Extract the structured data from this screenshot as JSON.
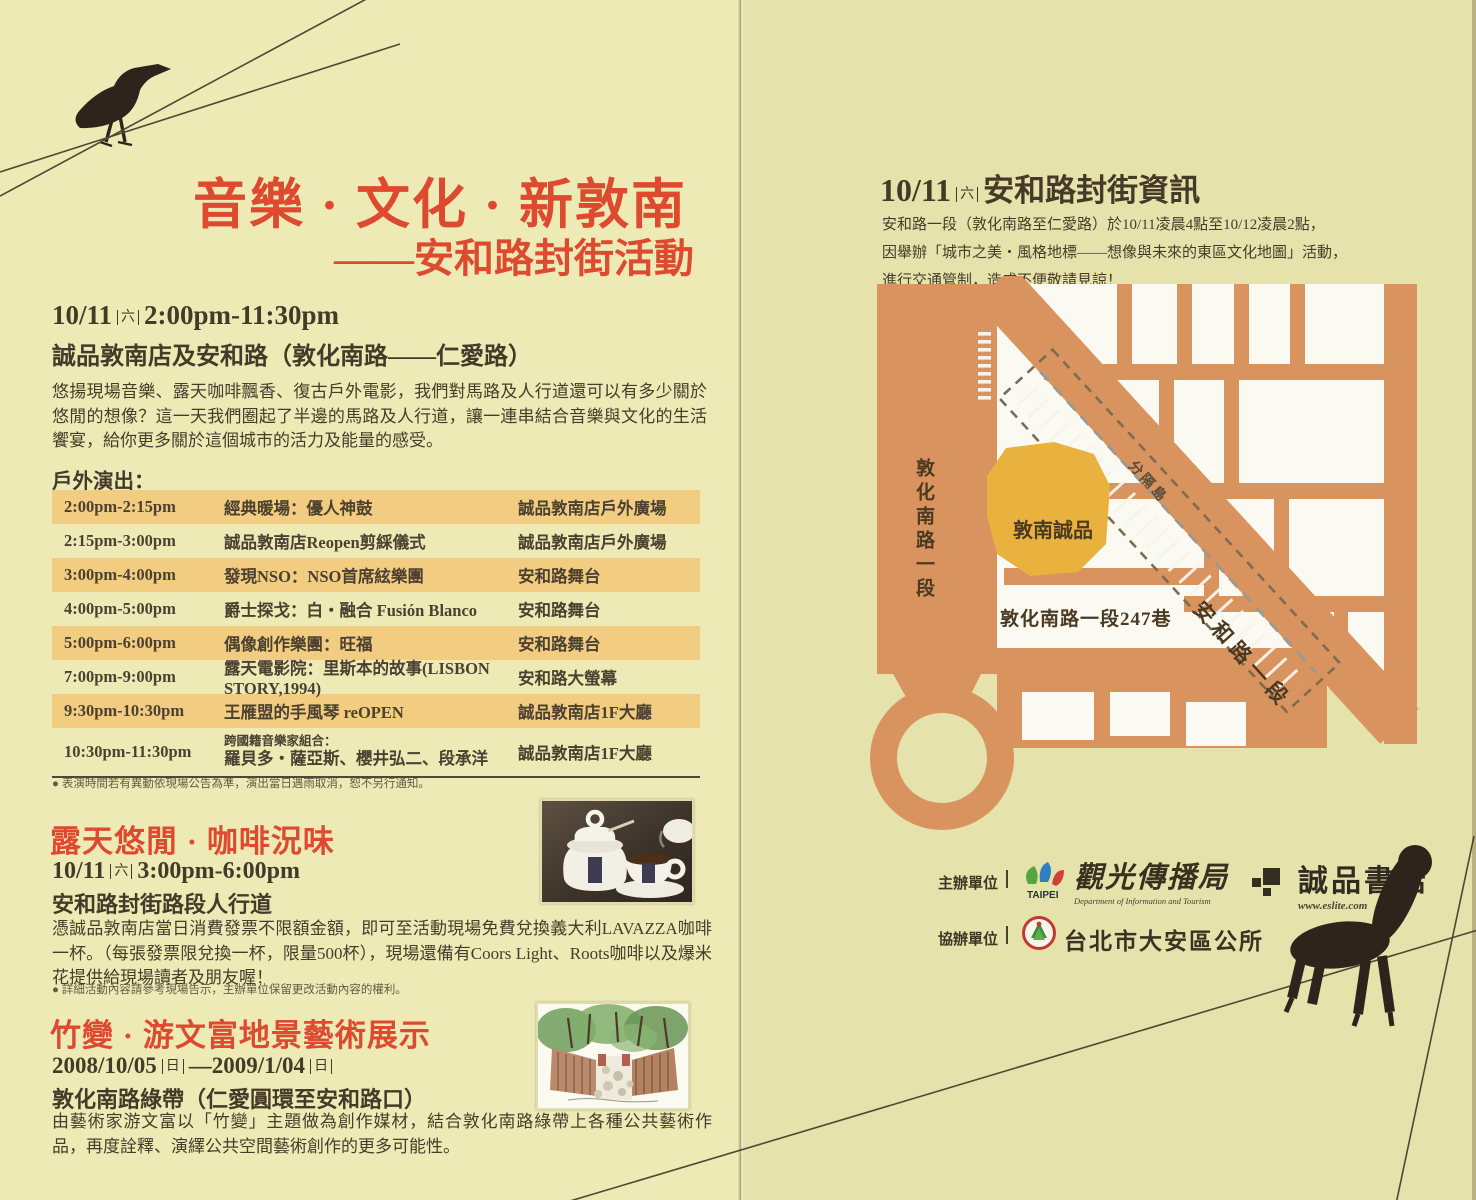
{
  "left": {
    "title_line1": "音樂 · 文化 · 新敦南",
    "title_line2": "——安和路封街活動",
    "event": {
      "date": "10/11",
      "weekday": "六",
      "time": "2:00pm-11:30pm",
      "venue": "誠品敦南店及安和路（敦化南路——仁愛路）",
      "description": "悠揚現場音樂、露天咖啡飄香、復古戶外電影，我們對馬路及人行道還可以有多少關於悠閒的想像？這一天我們圈起了半邊的馬路及人行道，讓一連串結合音樂與文化的生活饗宴，給你更多關於這個城市的活力及能量的感受。"
    },
    "schedule": {
      "heading": "戶外演出：",
      "rows": [
        {
          "time": "2:00pm-2:15pm",
          "program": "經典暖場：優人神鼓",
          "venue": "誠品敦南店戶外廣場"
        },
        {
          "time": "2:15pm-3:00pm",
          "program": "誠品敦南店Reopen剪綵儀式",
          "venue": "誠品敦南店戶外廣場"
        },
        {
          "time": "3:00pm-4:00pm",
          "program": "發現NSO：NSO首席絃樂團",
          "venue": "安和路舞台"
        },
        {
          "time": "4:00pm-5:00pm",
          "program": "爵士探戈：白・融合 Fusión Blanco",
          "venue": "安和路舞台"
        },
        {
          "time": "5:00pm-6:00pm",
          "program": "偶像創作樂團：旺福",
          "venue": "安和路舞台"
        },
        {
          "time": "7:00pm-9:00pm",
          "program": "露天電影院：里斯本的故事(LISBON STORY,1994)",
          "venue": "安和路大螢幕"
        },
        {
          "time": "9:30pm-10:30pm",
          "program": "王雁盟的手風琴 reOPEN",
          "venue": "誠品敦南店1F大廳"
        },
        {
          "time": "10:30pm-11:30pm",
          "program_note": "跨國籍音樂家組合：",
          "program": "羅貝多・薩亞斯、櫻井弘二、段承洋",
          "venue": "誠品敦南店1F大廳"
        }
      ],
      "footnote": "● 表演時間若有異動依現場公告為準，演出當日遇雨取消，恕不另行通知。"
    },
    "coffee": {
      "heading": "露天悠閒 · 咖啡況味",
      "date": "10/11",
      "weekday": "六",
      "time": "3:00pm-6:00pm",
      "venue": "安和路封街路段人行道",
      "description": "憑誠品敦南店當日消費發票不限額金額，即可至活動現場免費兌換義大利LAVAZZA咖啡一杯。（每張發票限兌換一杯，限量500杯），現場還備有Coors Light、Roots咖啡以及爆米花提供給現場讀者及朋友喔！",
      "footnote": "● 詳細活動內容請參考現場告示，主辦單位保留更改活動內容的權利。"
    },
    "bamboo": {
      "heading": "竹變 · 游文富地景藝術展示",
      "date_start": "2008/10/05",
      "weekday_start": "日",
      "dash": "—",
      "date_end": "2009/1/04",
      "weekday_end": "日",
      "venue": "敦化南路綠帶（仁愛圓環至安和路口）",
      "description": "由藝術家游文富以「竹變」主題做為創作媒材，結合敦化南路綠帶上各種公共藝術作品，再度詮釋、演繹公共空間藝術創作的更多可能性。"
    }
  },
  "right": {
    "info": {
      "date": "10/11",
      "weekday": "六",
      "title": "安和路封街資訊",
      "line1": "安和路一段（敦化南路至仁愛路）於10/11凌晨4點至10/12凌晨2點，",
      "line2": "因舉辦「城市之美・風格地標——想像與未來的東區文化地圖」活動，",
      "line3": "進行交通管制，造成不便敬請見諒！"
    },
    "map": {
      "road_vertical": "敦化南路一段",
      "road_diagonal": "安和路一段",
      "lane": "敦化南路一段247巷",
      "building": "敦南誠品",
      "median": "分隔島"
    },
    "organizers": {
      "host_label": "主辦單位",
      "host1_logo_text": "TAIPEI",
      "host1_name": "觀光傳播局",
      "host1_caption": "Department of Information and Tourism",
      "host2_name": "誠品書店",
      "host2_url": "www.eslite.com",
      "co_label": "協辦單位",
      "co_name": "台北市大安區公所"
    }
  },
  "colors": {
    "accent_red": "#dd4a2f",
    "table_highlight": "#f2cc80",
    "map_road": "#d9935f",
    "map_building": "#e9b23e"
  }
}
